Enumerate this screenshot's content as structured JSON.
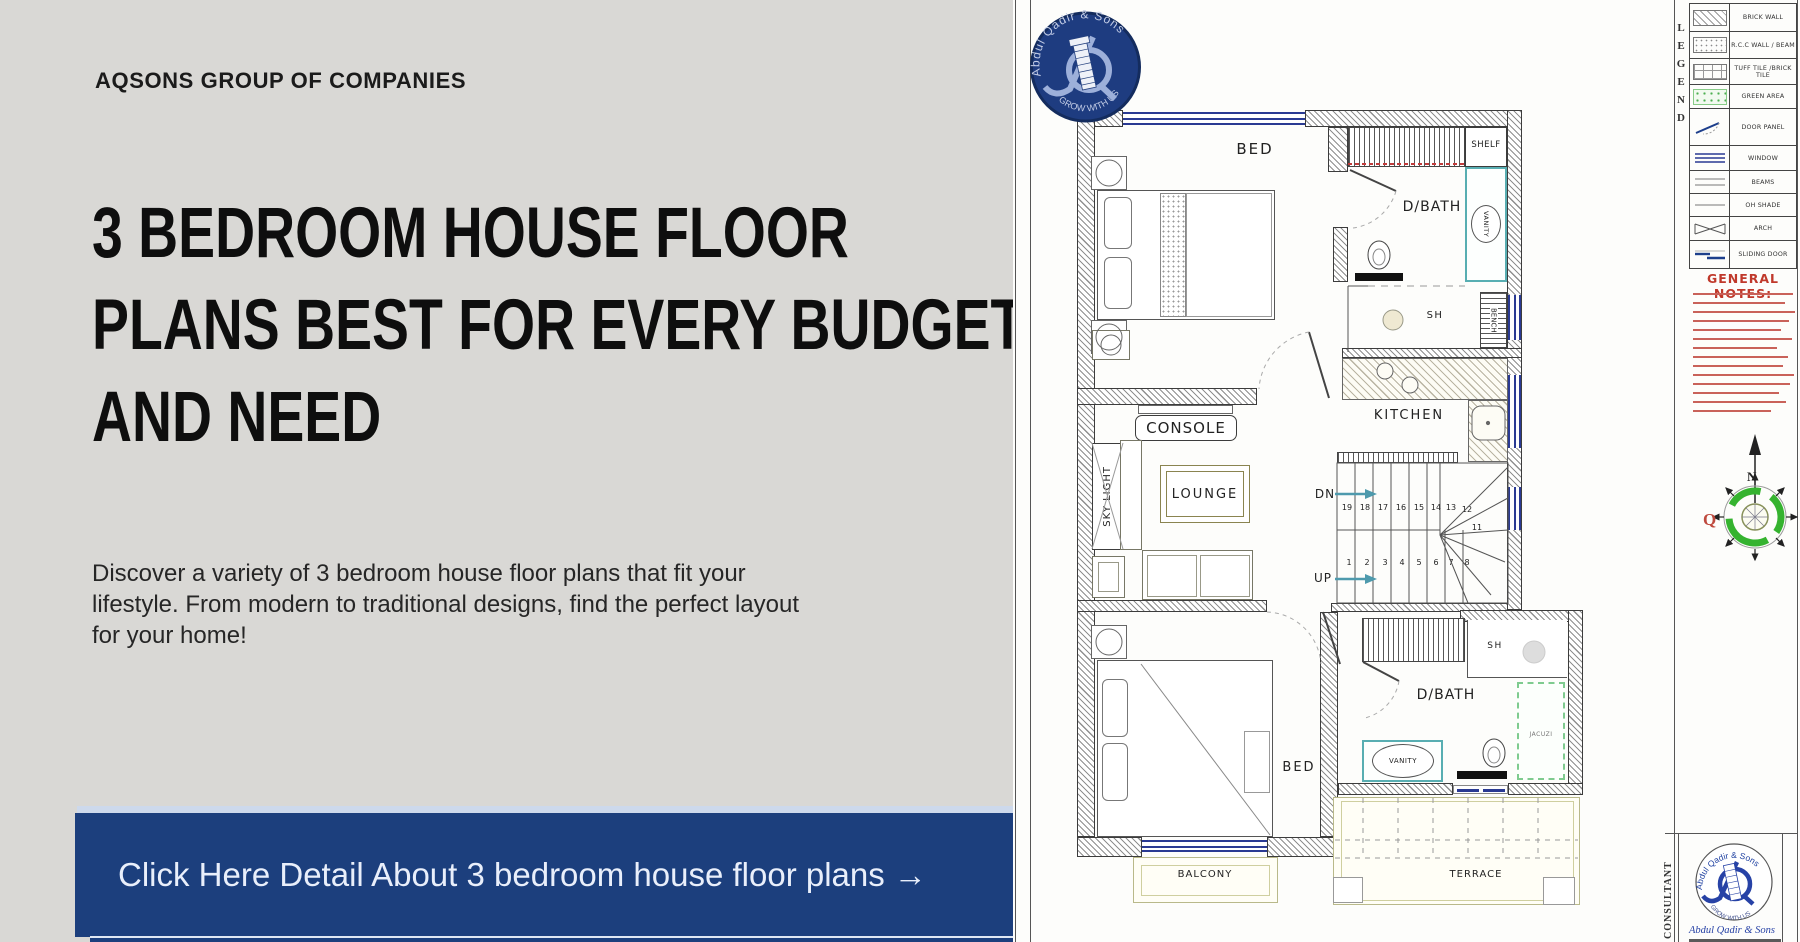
{
  "brand": "AQSONS GROUP OF COMPANIES",
  "headline": [
    "3 BEDROOM HOUSE FLOOR",
    "PLANS BEST FOR EVERY BUDGET",
    "AND NEED"
  ],
  "description": [
    "Discover a variety of 3 bedroom house floor plans that fit your",
    "lifestyle. From modern to traditional designs, find the perfect layout",
    "for your home!"
  ],
  "cta": {
    "label": "Click Here Detail About 3 bedroom house floor plans →"
  },
  "logo": {
    "arc_top": "Abdul Qadir & Sons",
    "arc_bottom": "GROW WITH US"
  },
  "plan": {
    "rooms": {
      "bed_top": "BED",
      "shelf": "SHELF",
      "dbath_top": "D/BATH",
      "vanity_top": "VANITY",
      "sh_top": "SH",
      "bench": "BENCH",
      "console": "CONSOLE",
      "skylight": "SKY LIGHT",
      "lounge": "LOUNGE",
      "kitchen": "KITCHEN",
      "dn": "DN",
      "up": "UP",
      "bed_bottom": "BED",
      "dbath_bottom": "D/BATH",
      "vanity_bottom": "VANITY",
      "sh_bottom": "SH",
      "jacuzzi": "JACUZI",
      "balcony": "BALCONY",
      "terrace": "TERRACE"
    },
    "stairs": {
      "upper": [
        "19",
        "18",
        "17",
        "16",
        "15",
        "14",
        "13",
        "12",
        "11"
      ],
      "lower": [
        "1",
        "2",
        "3",
        "4",
        "5",
        "6",
        "7",
        "8"
      ]
    }
  },
  "legend": {
    "title": "LEGEND",
    "items": [
      {
        "swatch": "brick-wall-swatch",
        "label": "BRICK WALL"
      },
      {
        "swatch": "rcc-wall-beam-swatch",
        "label": "R.C.C WALL / BEAM"
      },
      {
        "swatch": "tuff-tile-swatch",
        "label": "TUFF TILE /BRICK TILE"
      },
      {
        "swatch": "green-area-swatch",
        "label": "GREEN AREA"
      },
      {
        "swatch": "door-panel-swatch",
        "label": "DOOR PANEL"
      },
      {
        "swatch": "window-swatch",
        "label": "WINDOW"
      },
      {
        "swatch": "beams-swatch",
        "label": "BEAMS"
      },
      {
        "swatch": "oh-shade-swatch",
        "label": "OH SHADE"
      },
      {
        "swatch": "arch-swatch",
        "label": "ARCH"
      },
      {
        "swatch": "sliding-door-swatch",
        "label": "SLIDING DOOR"
      }
    ]
  },
  "notes": {
    "title": "GENERAL NOTES:"
  },
  "compass": {
    "north": "N",
    "mark": "Q"
  },
  "consultant": {
    "label": "CONSULTANT",
    "firm": "Abdul Qadir & Sons"
  },
  "colors": {
    "panel_bg": "#d9d8d5",
    "cta_bg": "#1c3f7d",
    "logo_navy": "#1e3c80",
    "notes_red": "#c0392b",
    "window_blue": "#2a3a93",
    "vanity_cyan": "#58aeb2",
    "jacuzzi_green": "#7fcb8f",
    "compass_green": "#35b32f"
  }
}
